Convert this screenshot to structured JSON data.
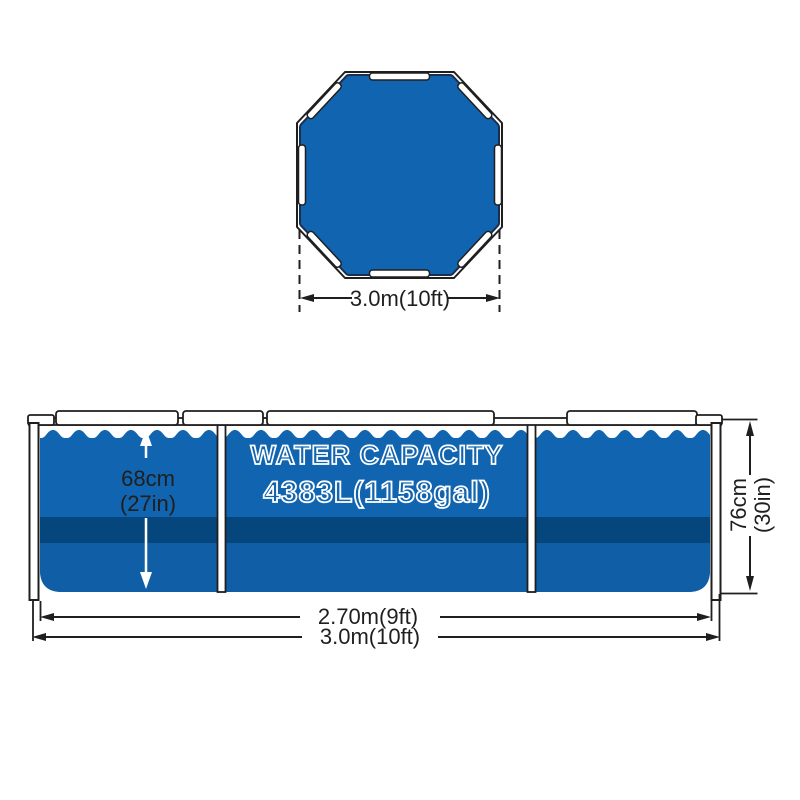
{
  "diagram": {
    "top_view": {
      "width_label": "3.0m(10ft)"
    },
    "side_view": {
      "capacity_line1": "WATER CAPACITY",
      "capacity_line2": "4383L(1158gal)",
      "depth_line1": "68cm",
      "depth_line2": "(27in)",
      "height_line1": "76cm",
      "height_line2": "(30in)",
      "inner_width_label": "2.70m(9ft)",
      "outer_width_label": "3.0m(10ft)"
    }
  },
  "colors": {
    "pool_blue": "#1164af",
    "band_dark": "#05477d",
    "lower_blue": "#0f5ea6",
    "liner_outline": "#1b2f4d",
    "line": "#1f1f1f",
    "white": "#ffffff"
  }
}
